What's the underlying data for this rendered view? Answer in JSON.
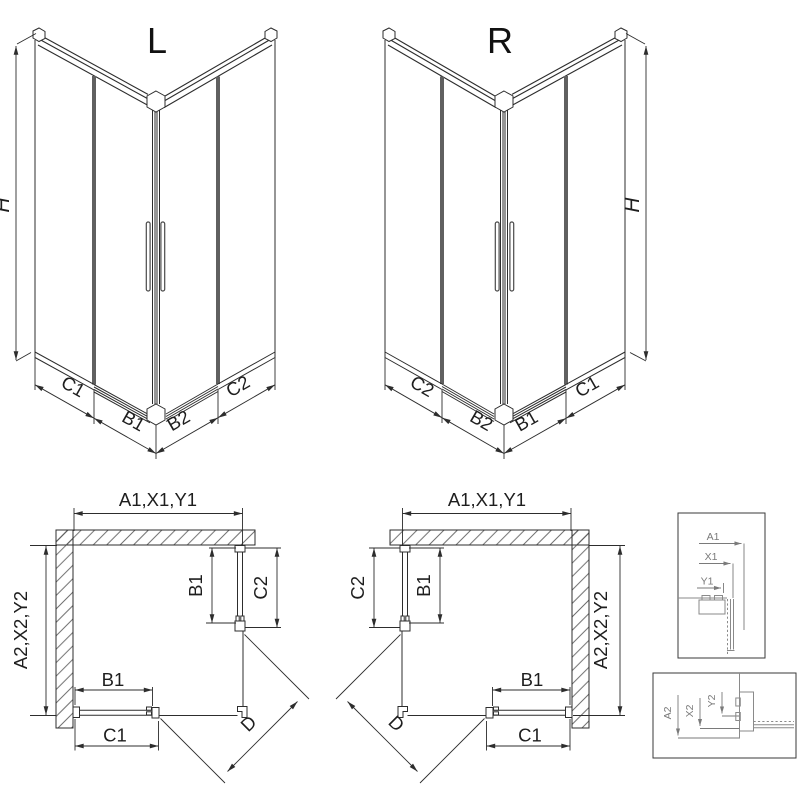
{
  "drawing": {
    "iso_left": {
      "label": "L",
      "dim_height": "H",
      "dims_left_wall": [
        "C1",
        "B1"
      ],
      "dims_right_wall": [
        "B2",
        "C2"
      ]
    },
    "iso_right": {
      "label": "R",
      "dim_height": "H",
      "dims_left_wall": [
        "C2",
        "B2"
      ],
      "dims_right_wall": [
        "B1",
        "C1"
      ]
    },
    "plan_left": {
      "dim_top": "A1,X1,Y1",
      "dim_side": "A2,X2,Y2",
      "dim_side_door": "B1",
      "dim_side_fixed": "C2",
      "dim_bottom_door": "B1",
      "dim_bottom_fixed": "C1",
      "dim_diagonal": "D"
    },
    "plan_right": {
      "dim_top": "A1,X1,Y1",
      "dim_side": "A2,X2,Y2",
      "dim_side_door": "B1",
      "dim_side_fixed": "C2",
      "dim_bottom_door": "B1",
      "dim_bottom_fixed": "C1",
      "dim_diagonal": "D"
    },
    "detail_top": {
      "dims": [
        "A1",
        "X1",
        "Y1"
      ]
    },
    "detail_bottom": {
      "dims": [
        "A2",
        "X2",
        "Y2"
      ]
    },
    "colors": {
      "line": "#2d2d2d",
      "profile_bar": "#606060",
      "detail_gray": "#7a7a7a",
      "background": "#ffffff"
    }
  }
}
